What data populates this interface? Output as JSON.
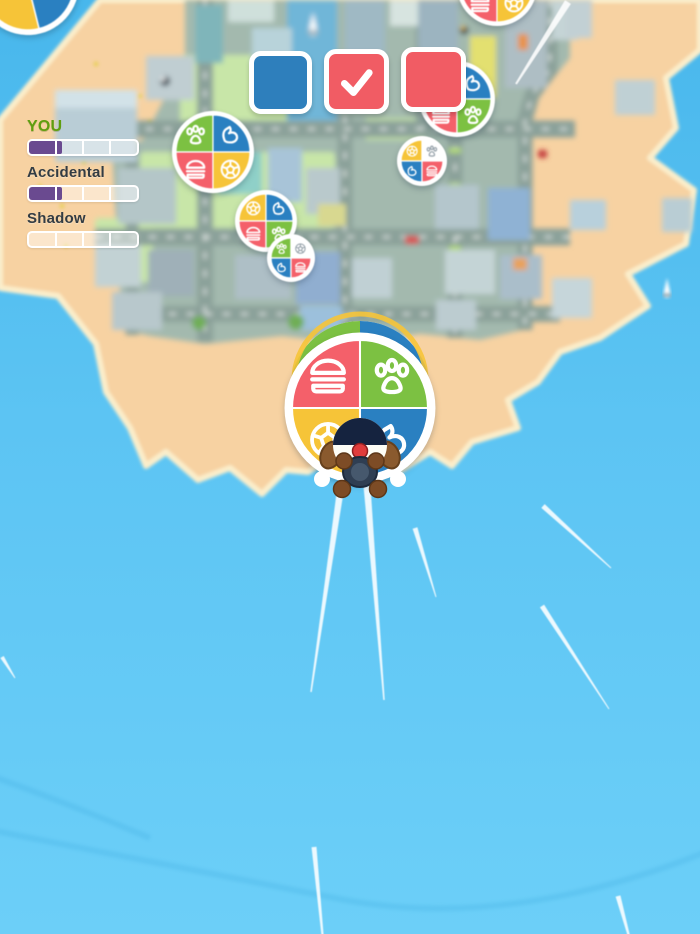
{
  "app": {
    "name": "skydive balloon arcade game"
  },
  "hud": {
    "objectives": {
      "squares": [
        {
          "color_name": "blue",
          "color": "#2e7fbc",
          "checked": false
        },
        {
          "color_name": "red",
          "color": "#f15c64",
          "checked": true
        },
        {
          "color_name": "red",
          "color": "#f15c64",
          "checked": false
        }
      ],
      "check_color": "#ffffff"
    },
    "leaderboard": {
      "entries": [
        {
          "name": "YOU",
          "is_player": true,
          "progress": 0.31,
          "segments": 4
        },
        {
          "name": "Accidental",
          "is_player": false,
          "progress": 0.31,
          "segments": 4
        },
        {
          "name": "Shadow",
          "is_player": false,
          "progress": 0.0,
          "segments": 4
        }
      ],
      "fill_color": "#6a4a90",
      "player_name_color": "#5f9e0f",
      "opponent_name_color": "#333c43"
    }
  },
  "palette": {
    "quadrant_colors": {
      "red": "#f4606a",
      "green": "#7cc142",
      "yellow": "#f6c438",
      "blue": "#2a80c1",
      "white": "#ffffff"
    },
    "icon_stroke": "#ffffff",
    "icon_stroke_collected": "#9aa5ad",
    "ocean_top": "#48b7ec",
    "ocean_bottom": "#6ccff8",
    "sand": "#f7d2a2",
    "city_base": "#a3b9ae"
  },
  "balloons": [
    {
      "id": "corner-balloon",
      "cx": 28,
      "cy": -16,
      "r": 46,
      "rot": -14,
      "quadrants": [
        {
          "pos": "tl",
          "color": "yellow"
        },
        {
          "pos": "tr",
          "color": "blue"
        },
        {
          "pos": "bl",
          "color": "yellow"
        },
        {
          "pos": "br",
          "color": "blue"
        }
      ]
    },
    {
      "id": "balloon-1",
      "cx": 213,
      "cy": 152,
      "r": 37,
      "quadrants": [
        {
          "pos": "tl",
          "color": "green",
          "icon": "paw"
        },
        {
          "pos": "tr",
          "color": "blue",
          "icon": "fist"
        },
        {
          "pos": "bl",
          "color": "red",
          "icon": "burger"
        },
        {
          "pos": "br",
          "color": "yellow",
          "icon": "soccer"
        }
      ]
    },
    {
      "id": "balloon-2",
      "cx": 266,
      "cy": 221,
      "r": 27,
      "quadrants": [
        {
          "pos": "tl",
          "color": "yellow",
          "icon": "soccer"
        },
        {
          "pos": "tr",
          "color": "blue",
          "icon": "fist"
        },
        {
          "pos": "bl",
          "color": "red",
          "icon": "burger"
        },
        {
          "pos": "br",
          "color": "green",
          "icon": "paw"
        }
      ]
    },
    {
      "id": "balloon-3",
      "cx": 291,
      "cy": 258,
      "r": 20,
      "quadrants": [
        {
          "pos": "tl",
          "color": "green",
          "icon": "paw"
        },
        {
          "pos": "tr",
          "color": "white",
          "icon": "soccer"
        },
        {
          "pos": "bl",
          "color": "blue",
          "icon": "fist"
        },
        {
          "pos": "br",
          "color": "red",
          "icon": "burger"
        }
      ]
    },
    {
      "id": "balloon-4",
      "cx": 457,
      "cy": 99,
      "r": 34,
      "quadrants": [
        {
          "pos": "tl",
          "color": "yellow",
          "icon": "soccer"
        },
        {
          "pos": "tr",
          "color": "blue",
          "icon": "fist"
        },
        {
          "pos": "bl",
          "color": "red",
          "icon": "burger"
        },
        {
          "pos": "br",
          "color": "green",
          "icon": "paw"
        }
      ]
    },
    {
      "id": "balloon-5",
      "cx": 422,
      "cy": 161,
      "r": 21,
      "quadrants": [
        {
          "pos": "tl",
          "color": "yellow",
          "icon": "soccer"
        },
        {
          "pos": "tr",
          "color": "white",
          "icon": "paw"
        },
        {
          "pos": "bl",
          "color": "blue",
          "icon": "fist"
        },
        {
          "pos": "br",
          "color": "red",
          "icon": "burger"
        }
      ]
    },
    {
      "id": "balloon-6",
      "cx": 497,
      "cy": -14,
      "r": 36,
      "quadrants": [
        {
          "pos": "tl",
          "color": "blue",
          "icon": "fist"
        },
        {
          "pos": "tr",
          "color": "green",
          "icon": "paw"
        },
        {
          "pos": "bl",
          "color": "red",
          "icon": "burger"
        },
        {
          "pos": "br",
          "color": "yellow",
          "icon": "soccer"
        }
      ]
    }
  ],
  "player": {
    "balloon": {
      "cx": 360,
      "cy": 408,
      "r": 68,
      "quadrants": [
        {
          "pos": "tl",
          "color": "red",
          "icon": "burger"
        },
        {
          "pos": "tr",
          "color": "green",
          "icon": "paw"
        },
        {
          "pos": "bl",
          "color": "yellow",
          "icon": "soccer"
        },
        {
          "pos": "br",
          "color": "blue",
          "icon": "fist"
        }
      ]
    }
  },
  "effects": {
    "speed_lines": [
      {
        "x1": 341,
        "y1": 486,
        "x2": 311,
        "y2": 692,
        "w1": 7,
        "w2": 1.5
      },
      {
        "x1": 367,
        "y1": 486,
        "x2": 384,
        "y2": 700,
        "w1": 7,
        "w2": 1.5
      },
      {
        "x1": 415,
        "y1": 528,
        "x2": 436,
        "y2": 597,
        "w1": 5,
        "w2": 1
      },
      {
        "x1": 543,
        "y1": 506,
        "x2": 611,
        "y2": 568,
        "w1": 5,
        "w2": 1
      },
      {
        "x1": 542,
        "y1": 606,
        "x2": 609,
        "y2": 709,
        "w1": 5,
        "w2": 1
      },
      {
        "x1": 314,
        "y1": 847,
        "x2": 323,
        "y2": 940,
        "w1": 5,
        "w2": 2
      },
      {
        "x1": 618,
        "y1": 896,
        "x2": 630,
        "y2": 940,
        "w1": 5,
        "w2": 2
      },
      {
        "x1": 2,
        "y1": 657,
        "x2": 15,
        "y2": 678,
        "w1": 4,
        "w2": 1
      },
      {
        "x1": 568,
        "y1": 2,
        "x2": 516,
        "y2": 84,
        "w1": 7,
        "w2": 2
      }
    ]
  }
}
